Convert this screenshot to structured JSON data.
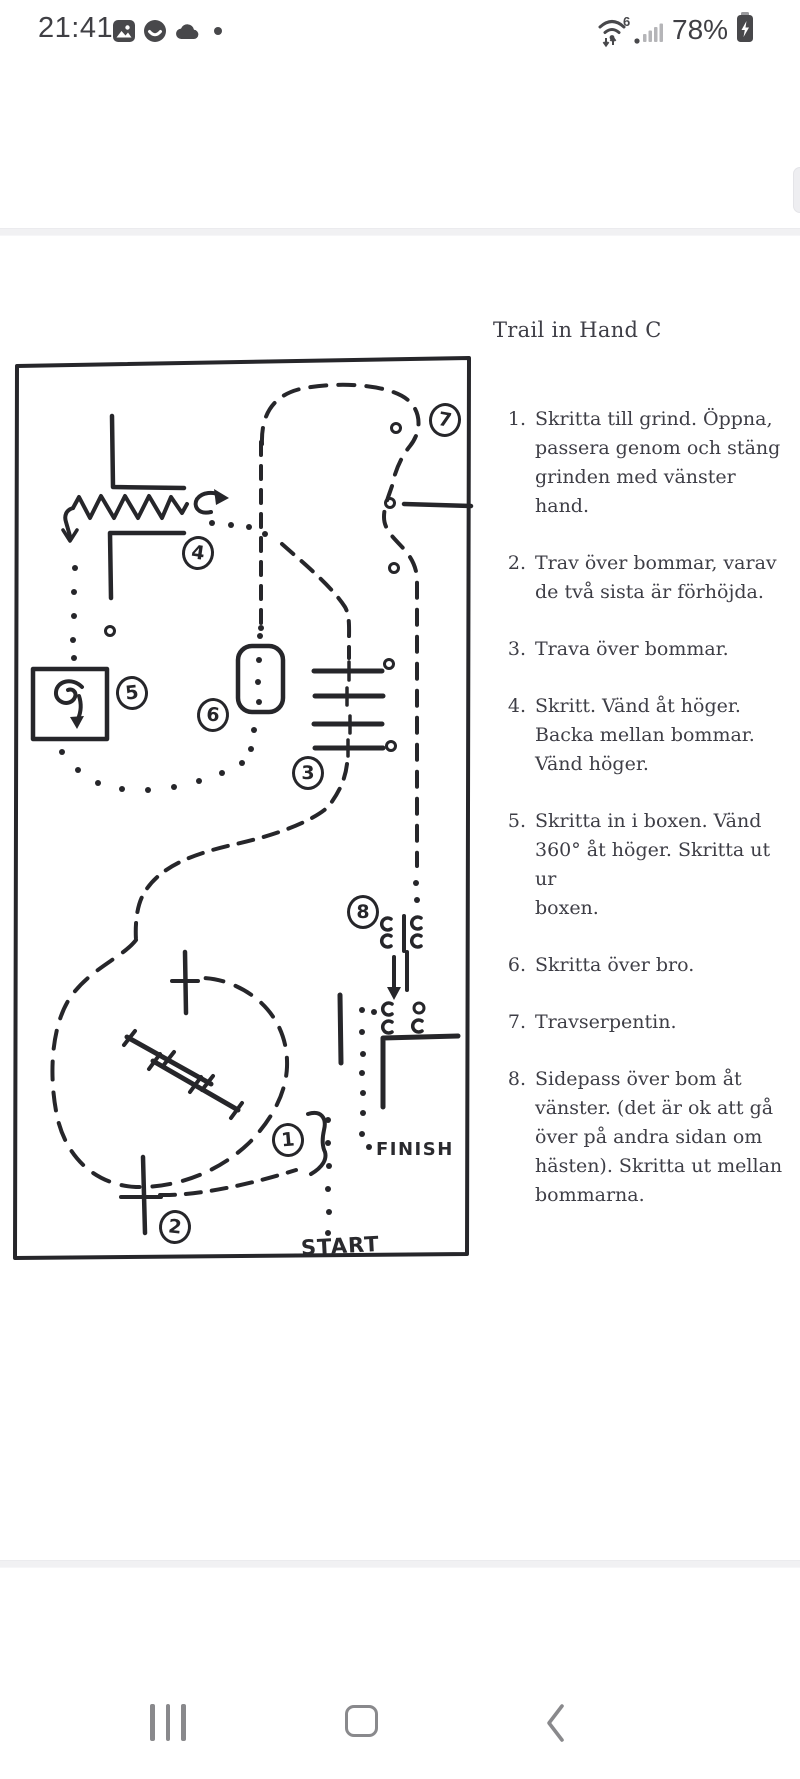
{
  "status_bar": {
    "time": "21:41",
    "wifi_generation": "6",
    "battery_percent": "78%"
  },
  "document": {
    "title": "Trail in Hand C",
    "course": {
      "start_label": "START",
      "finish_label": "FINISH",
      "markers": [
        {
          "label": "1"
        },
        {
          "label": "2"
        },
        {
          "label": "3"
        },
        {
          "label": "4"
        },
        {
          "label": "5"
        },
        {
          "label": "6"
        },
        {
          "label": "7"
        },
        {
          "label": "8"
        }
      ]
    },
    "instructions": [
      {
        "num": "1.",
        "lines": [
          "Skritta till grind. Öppna,",
          "passera genom och stäng",
          "grinden med vänster hand."
        ]
      },
      {
        "num": "2.",
        "lines": [
          "Trav över bommar, varav",
          "de två sista är förhöjda."
        ]
      },
      {
        "num": "3.",
        "lines": [
          "Trava över bommar."
        ]
      },
      {
        "num": "4.",
        "lines": [
          "Skritt. Vänd åt höger.",
          "Backa mellan bommar.",
          "Vänd höger."
        ]
      },
      {
        "num": "5.",
        "lines": [
          "Skritta in i boxen. Vänd",
          "360° åt höger. Skritta ut ur",
          "boxen."
        ]
      },
      {
        "num": "6.",
        "lines": [
          "Skritta över bro."
        ]
      },
      {
        "num": "7.",
        "lines": [
          "Travserpentin."
        ]
      },
      {
        "num": "8.",
        "lines": [
          "Sidepass över bom åt",
          "vänster. (det är ok att gå",
          "över på andra sidan om",
          "hästen). Skritta ut mellan",
          "bommarna."
        ]
      }
    ]
  }
}
